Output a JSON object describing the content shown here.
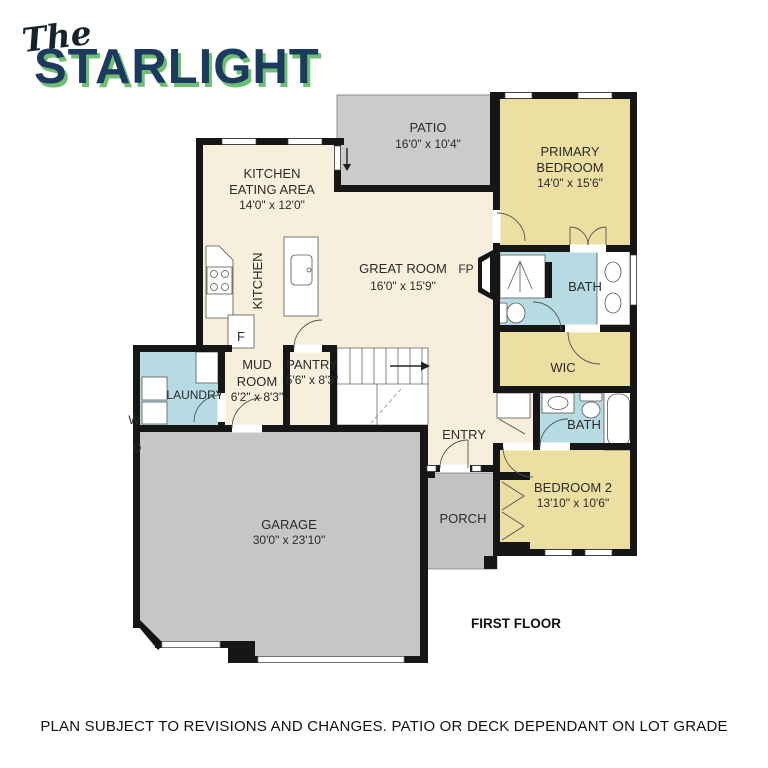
{
  "title": {
    "script": "The",
    "main": "STARLIGHT"
  },
  "plan": {
    "patio": {
      "name": "PATIO",
      "dims": "16'0\" x 10'4\""
    },
    "primary_bedroom": {
      "line1": "PRIMARY",
      "line2": "BEDROOM",
      "dims": "14'0\" x 15'6\""
    },
    "kitchen_eating": {
      "line1": "KITCHEN",
      "line2": "EATING AREA",
      "dims": "14'0\" x 12'0\""
    },
    "great_room": {
      "name": "GREAT ROOM",
      "dims": "16'0\" x 15'9\""
    },
    "kitchen": {
      "name": "KITCHEN"
    },
    "primary_bath": {
      "name": "BATH"
    },
    "wic": {
      "name": "WIC"
    },
    "mud_room": {
      "line1": "MUD",
      "line2": "ROOM",
      "dims": "6'2\" x 8'3\""
    },
    "pantry": {
      "name": "PANTRY",
      "dims": "5'6\" x 8'3\""
    },
    "laundry": {
      "name": "LAUNDRY"
    },
    "entry": {
      "name": "ENTRY"
    },
    "bath2": {
      "name": "BATH"
    },
    "bedroom2": {
      "name": "BEDROOM 2",
      "dims": "13'10\" x 10'6\""
    },
    "porch": {
      "name": "PORCH"
    },
    "garage": {
      "name": "GARAGE",
      "dims": "30'0\" x 23'10\""
    },
    "fireplace": "FP",
    "fridge": "F",
    "washer": "W",
    "dryer": "D"
  },
  "floor_label": "FIRST FLOOR",
  "disclaimer": "PLAN SUBJECT TO REVISIONS AND CHANGES. PATIO OR DECK DEPENDANT ON LOT GRADE",
  "colors": {
    "room_yellow": "#EBDFA2",
    "room_blue": "#B7DBE3",
    "room_cream": "#F7EEDC",
    "surface_gray": "#C8C8C8",
    "wall": "#161616",
    "title_navy": "#1B3A5E",
    "title_green": "#6FBF73"
  }
}
